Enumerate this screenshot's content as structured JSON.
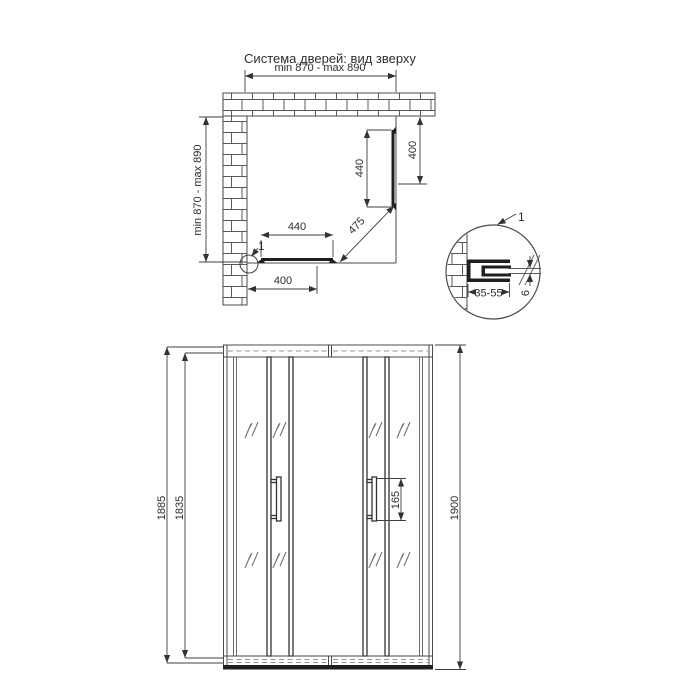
{
  "title": "Система дверей: вид зверху",
  "colors": {
    "background": "#ffffff",
    "line": "#4a4a4a",
    "profile_dark": "#1f1f1f",
    "text": "#2e2e2e"
  },
  "top_view": {
    "width_dim": "min 870 - max 890",
    "depth_dim": "min 870 - max 890",
    "right_door_width": "440",
    "right_opening_offset": "400",
    "bottom_door_width": "440",
    "bottom_opening_offset": "400",
    "diagonal_entry": "475",
    "detail_marker": "1"
  },
  "detail_view": {
    "marker": "1",
    "adjustment_range": "35-55",
    "glass_thickness": "6"
  },
  "front_view": {
    "total_height": "1900",
    "door_height": "1885",
    "glass_height": "1835",
    "handle_length": "165"
  }
}
